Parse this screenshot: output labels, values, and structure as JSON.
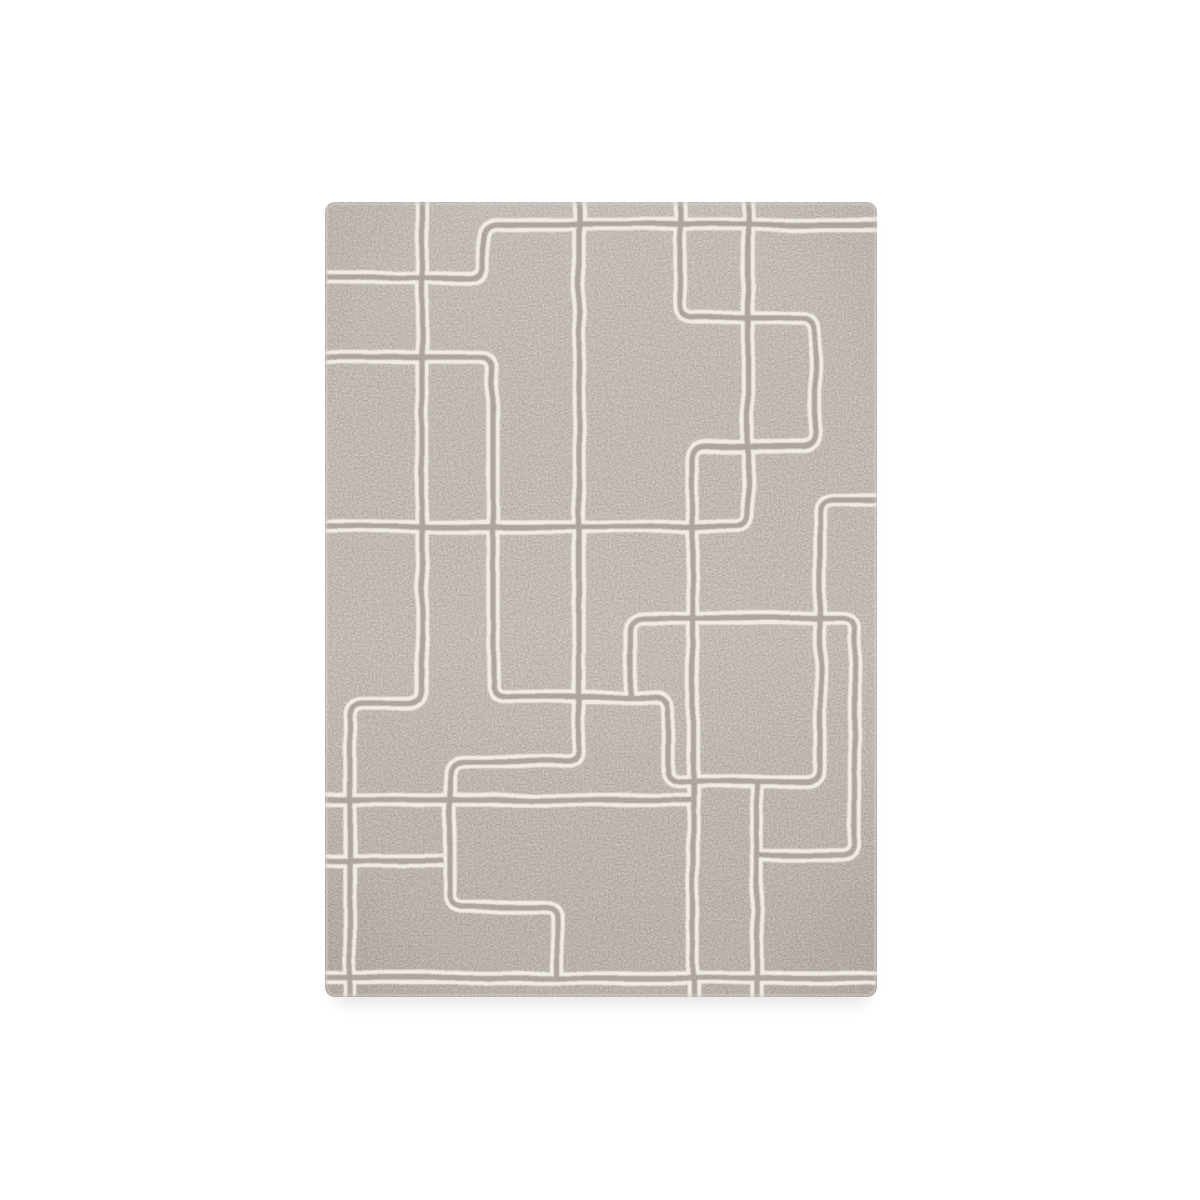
{
  "scene": {
    "type": "product-photo",
    "description": "Grey taupe hand-tufted wool rug with ivory double-line rectilinear maze pattern, photographed flat on a white background",
    "background_color": "#ffffff"
  },
  "rug": {
    "x": 325,
    "y": 202,
    "width": 552,
    "height": 795,
    "corner_radius": 10,
    "field_color": "#b1a8a0",
    "line_color": "#f1ece4",
    "gap_color": "#a89f97",
    "edge_color": "#d8d1c8",
    "shadow_color": "#8a827a",
    "line_outer_width": 13.5,
    "line_inner_width": 5.5,
    "pattern_style": "double-line tufted maze, rounded corners",
    "paths": [
      "M 325 278 H 469 Q 483 278 483 264 V 239 Q 483 225 497 225 H 877",
      "M 422 202 V 689 Q 422 703 408 703 H 364 Q 350 703 350 717 V 997",
      "M 579 202 V 748 Q 579 762 565 762 H 464 Q 450 762 450 776 V 893 Q 450 907 464 907 H 543 Q 557 907 557 921 V 978",
      "M 748 202 V 513 Q 748 527 734 527 H 325",
      "M 680 202 V 304 Q 680 318 694 318 H 801 Q 815 318 815 332 V 433 Q 815 447 801 447 H 707 Q 693 447 693 461 V 997",
      "M 325 357 H 479 Q 493 357 493 371 V 683 Q 493 697 507 697 H 654 Q 668 697 668 711 V 768 Q 668 782 682 782 H 806 Q 820 782 820 768 V 514 Q 820 500 834 500 H 877",
      "M 630 697 V 632 Q 630 618 644 618 H 841 Q 855 618 855 632 V 841 Q 855 855 841 855 H 757",
      "M 757 782 V 997",
      "M 325 800 H 693",
      "M 325 861 H 443",
      "M 325 978 H 877"
    ]
  }
}
